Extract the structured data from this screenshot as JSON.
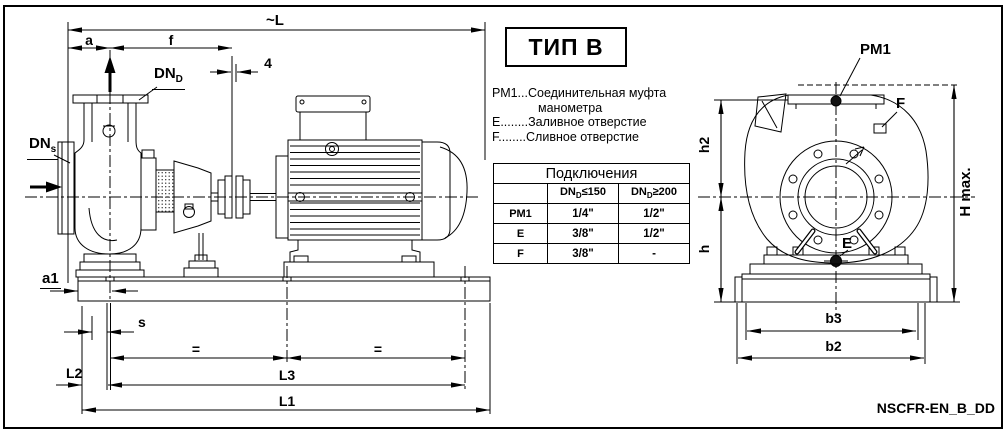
{
  "type_box": {
    "label": "ТИП B"
  },
  "legend": {
    "line1": "РМ1...Соединительная муфта",
    "line2": "манометра",
    "line3": "Е........Заливное отверстие",
    "line4": "F........Сливное отверстие"
  },
  "connections_table": {
    "title": "Подключения",
    "col1": {
      "base": "DN",
      "sub": "D",
      "cond": "≤150"
    },
    "col2": {
      "base": "DN",
      "sub": "D",
      "cond": "≥200"
    },
    "rows": [
      {
        "label": "РМ1",
        "v1": "1/4\"",
        "v2": "1/2\""
      },
      {
        "label": "Е",
        "v1": "3/8\"",
        "v2": "1/2\""
      },
      {
        "label": "F",
        "v1": "3/8\"",
        "v2": "-"
      }
    ]
  },
  "side_view": {
    "dim_overall_length": "~L",
    "dim_a": "a",
    "dim_f": "f",
    "dim_gap": "4",
    "discharge_nozzle": {
      "base": "DN",
      "sub": "D"
    },
    "suction_nozzle": {
      "base": "DN",
      "sub": "s"
    },
    "dim_a1": "a1",
    "dim_s": "s",
    "dim_equal_left": "=",
    "dim_equal_right": "=",
    "dim_L2": "L2",
    "dim_L3": "L3",
    "dim_L1": "L1"
  },
  "front_view": {
    "label_pm1": "PM1",
    "label_drain": "F",
    "label_fill": "E",
    "dim_h2": "h2",
    "dim_h": "h",
    "dim_h_max": "H max.",
    "dim_b3": "b3",
    "dim_b2": "b2"
  },
  "footer": {
    "drawing_code": "NSCFR-EN_B_DD"
  }
}
